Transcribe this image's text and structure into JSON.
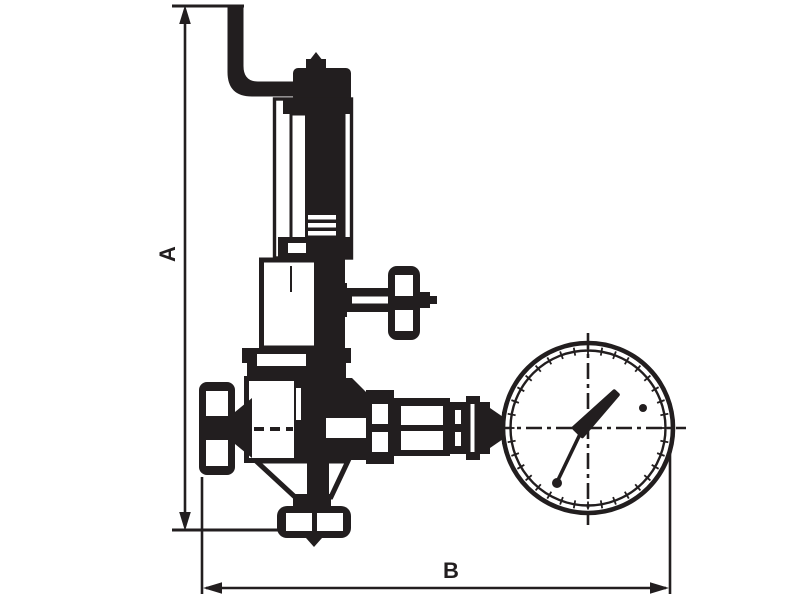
{
  "page": {
    "background": "#ffffff"
  },
  "drawing": {
    "kind": "technical-line-drawing",
    "subject": "pressure relief / reducing valve with pressure gauge",
    "ink_color": "#221e1f",
    "dimension_labels": {
      "vertical": "A",
      "horizontal": "B"
    }
  }
}
